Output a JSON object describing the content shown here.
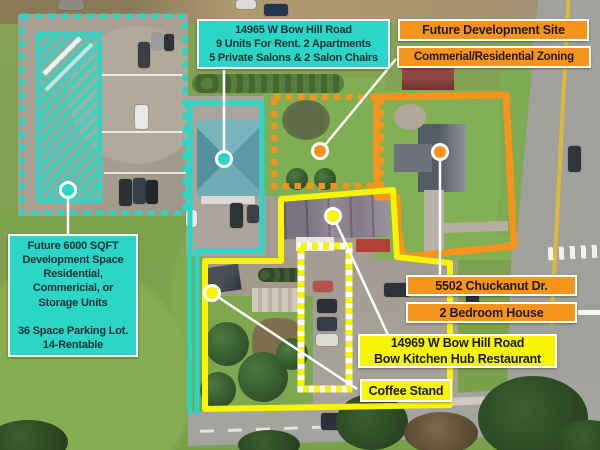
{
  "colors": {
    "cyan_accent": "#2BD6C6",
    "orange_accent": "#F7941E",
    "yellow_accent": "#F7F404",
    "connector_white": "#FFFFFF",
    "label_text_dark": "#1C1C10"
  },
  "labels": {
    "salon_property": {
      "text": "14965 W Bow Hill Road\n9 Units For Rent. 2 Apartments\n5 Private Salons & 2 Salon Chairs"
    },
    "future_site": {
      "text": "Future Development Site"
    },
    "zoning": {
      "text": "Commerial/Residential Zoning"
    },
    "development_space": {
      "text": "Future 6000 SQFT\nDevelopment Space\nResidential,\nCommericial, or\nStorage Units\n\n36 Space Parking Lot.\n14-Rentable"
    },
    "house_address": {
      "text": "5502 Chuckanut Dr."
    },
    "house_type": {
      "text": "2 Bedroom House"
    },
    "restaurant": {
      "text": "14969 W Bow Hill Road\nBow Kitchen Hub Restaurant"
    },
    "coffee_stand": {
      "text": "Coffee Stand"
    }
  },
  "annotations": {
    "marker_dots": [
      "parking-lot-marker",
      "salon-marker",
      "future-site-marker",
      "house-marker",
      "restaurant-marker",
      "coffee-stand-marker"
    ],
    "outlines": [
      "parking-lot-dashed-cyan",
      "development-hatch-cyan",
      "salon-property-cyan",
      "future-site-dashed-orange",
      "house-property-orange",
      "restaurant-property-yellow",
      "coffee-stand-dashed-yellow"
    ]
  }
}
